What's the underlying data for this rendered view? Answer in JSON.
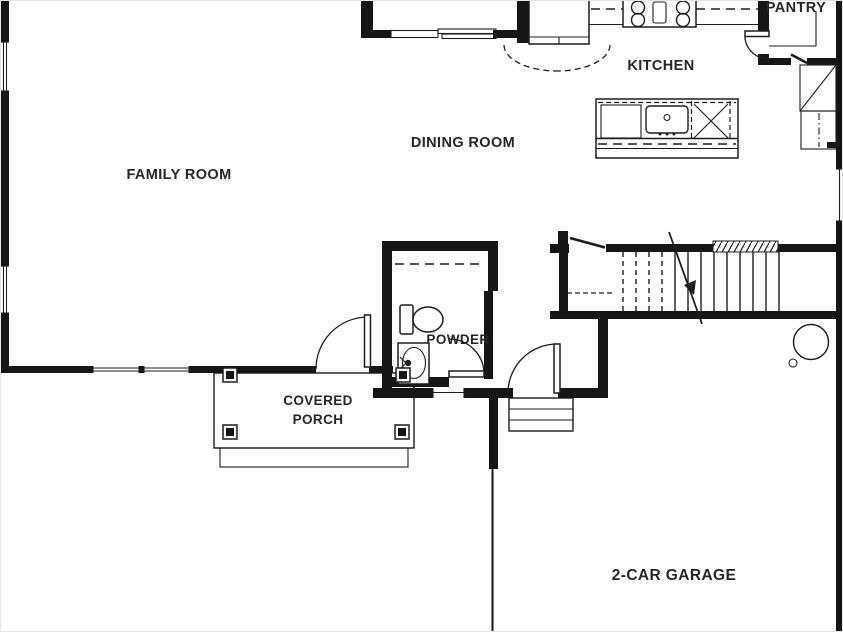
{
  "plan": {
    "title": "First floor plan",
    "labels": {
      "family_room": "FAMILY ROOM",
      "dining_room": "DINING ROOM",
      "kitchen": "KITCHEN",
      "pantry": "PANTRY",
      "powder": "POWDER",
      "porch_line1": "COVERED",
      "porch_line2": "PORCH",
      "garage": "2-CAR GARAGE"
    },
    "colors": {
      "wall": "#161616",
      "line": "#1d1d1d",
      "text": "#262626",
      "background": "#ffffff"
    },
    "fixtures": [
      "refrigerator",
      "range-cooktop",
      "kitchen-island",
      "island-sink",
      "dishwasher",
      "pantry-shelves",
      "stairs-up-arrow",
      "under-stair-closet",
      "coat-closet",
      "toilet",
      "vanity-sink",
      "water-heater",
      "furnace-units",
      "porch-posts",
      "garage-steps"
    ]
  }
}
